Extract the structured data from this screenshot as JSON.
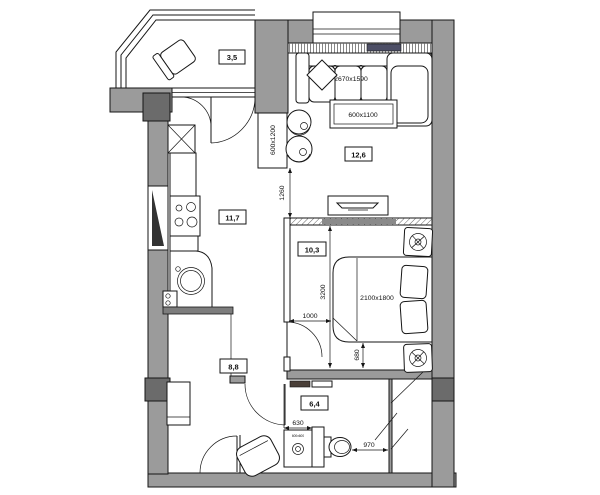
{
  "plan": {
    "rooms": {
      "balcony": {
        "area": "3,5"
      },
      "living_room": {
        "area": "12,6"
      },
      "kitchen": {
        "area": "11,7"
      },
      "bedroom": {
        "area": "10,3"
      },
      "hallway": {
        "area": "8,8"
      },
      "bathroom": {
        "area": "6,4"
      }
    },
    "furniture": {
      "sofa_size": "2670x1590",
      "coffee_table_size": "600x1100",
      "wardrobe_size": "600x1200",
      "bed_size": "2100x1800",
      "washer_size": "600x600"
    },
    "dimensions": {
      "corridor_width": "1260",
      "bedroom_length": "3200",
      "wall_to_bed": "1000",
      "bed_to_wall": "680",
      "washer_niche": "630",
      "toilet_clearance": "970"
    },
    "colors": {
      "wall": "#9b9b9b",
      "column": "#6b6b6b",
      "line": "#161616",
      "radiator": "#4d4f66"
    }
  }
}
